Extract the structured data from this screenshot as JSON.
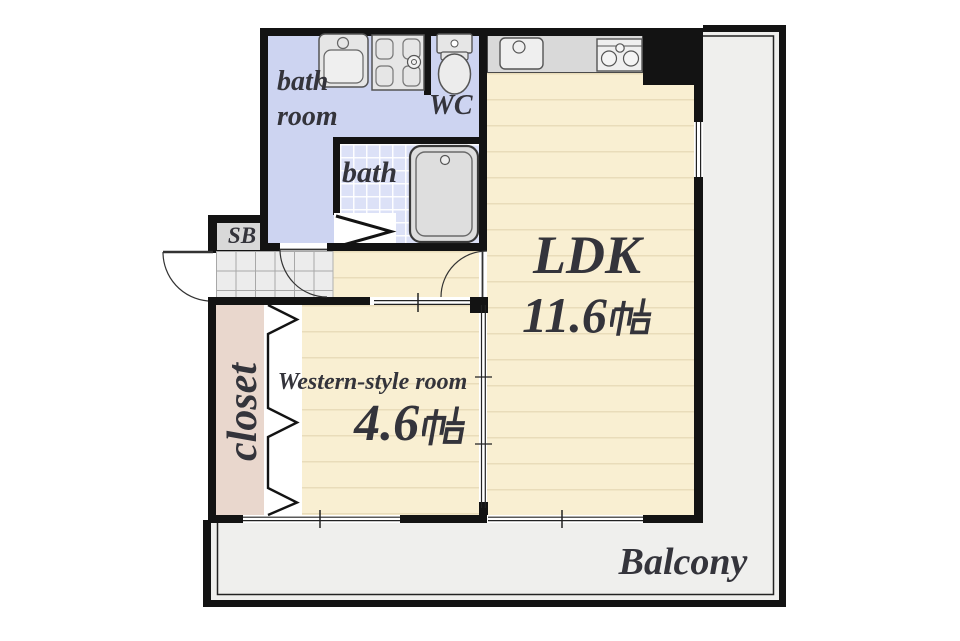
{
  "floor_plan": {
    "rooms": {
      "bathroom": {
        "label_line1": "bath",
        "label_line2": "room"
      },
      "wc": {
        "label": "WC"
      },
      "bath": {
        "label": "bath"
      },
      "shoe_box": {
        "label": "SB"
      },
      "ldk": {
        "name": "LDK",
        "area": "11.6帖",
        "area_number": "11.6",
        "area_unit": "帖"
      },
      "western_room": {
        "name": "Western-style room",
        "area": "4.6帖",
        "area_number": "4.6",
        "area_unit": "帖"
      },
      "closet": {
        "label": "closet"
      },
      "balcony": {
        "label": "Balcony"
      }
    },
    "fixtures": [
      "washbasin",
      "washing-machine-pan",
      "toilet",
      "bathtub",
      "kitchen-sink",
      "gas-stove",
      "shoe-box",
      "entry-door",
      "folding-doors",
      "sliding-doors",
      "windows"
    ],
    "colors": {
      "wall": "#131313",
      "bathroom_floor": "#cdd4f1",
      "bath_tile": "#dce1f7",
      "flooring": "#f9efd2",
      "flooring_line": "#e9dcba",
      "closet": "#e9d7cd",
      "balcony": "#efefed",
      "entrance_tile": "#ececec",
      "counter": "#d9d9d9",
      "text": "#34343b"
    }
  }
}
